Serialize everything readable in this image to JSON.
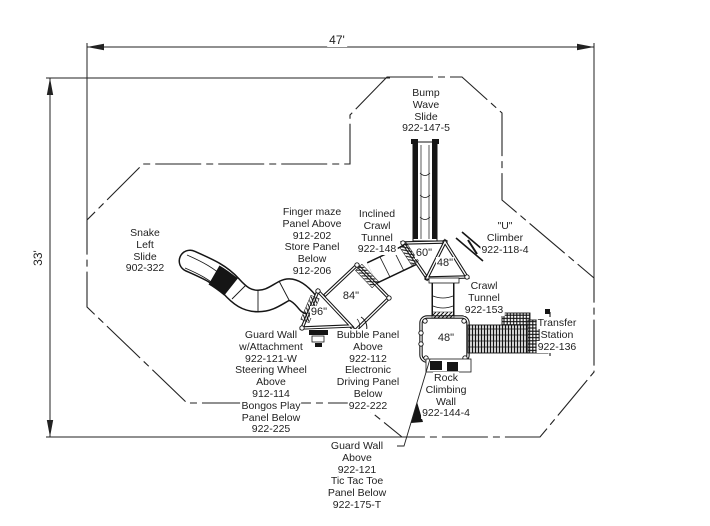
{
  "drawing_type": "playground plan view",
  "colors": {
    "line": "#222222",
    "equipment_line": "#151515",
    "text": "#1f1f1f",
    "background": "#ffffff"
  },
  "dimensions": {
    "width_label": "47'",
    "height_label": "33'"
  },
  "deck_labels": [
    {
      "id": "deck-84",
      "text": "84\"",
      "x": 351,
      "y": 296
    },
    {
      "id": "deck-96",
      "text": "96\"",
      "x": 319,
      "y": 312
    },
    {
      "id": "deck-60",
      "text": "60\"",
      "x": 424,
      "y": 253
    },
    {
      "id": "deck-48-triangle",
      "text": "48\"",
      "x": 445,
      "y": 263
    },
    {
      "id": "deck-48-square",
      "text": "48\"",
      "x": 446,
      "y": 338
    }
  ],
  "equipment_labels": [
    {
      "id": "snake-left-slide",
      "x": 145,
      "y": 228,
      "lines": [
        "Snake",
        "Left",
        "Slide",
        "902-322"
      ]
    },
    {
      "id": "finger-maze-panel",
      "x": 312,
      "y": 207,
      "lines": [
        "Finger maze",
        "Panel Above",
        "912-202",
        "Store Panel",
        "Below",
        "912-206"
      ]
    },
    {
      "id": "inclined-crawl-tunnel",
      "x": 377,
      "y": 209,
      "lines": [
        "Inclined",
        "Crawl",
        "Tunnel",
        "922-148"
      ]
    },
    {
      "id": "bump-wave-slide",
      "x": 426,
      "y": 88,
      "lines": [
        "Bump",
        "Wave",
        "Slide",
        "922-147-5"
      ]
    },
    {
      "id": "u-climber",
      "x": 505,
      "y": 221,
      "lines": [
        "\"U\"",
        "Climber",
        "922-118-4"
      ]
    },
    {
      "id": "crawl-tunnel",
      "x": 484,
      "y": 281,
      "lines": [
        "Crawl",
        "Tunnel",
        "922-153"
      ]
    },
    {
      "id": "transfer-station",
      "x": 557,
      "y": 318,
      "lines": [
        "Transfer",
        "Station",
        "922-136"
      ]
    },
    {
      "id": "guard-wall-attachment",
      "x": 271,
      "y": 330,
      "lines": [
        "Guard Wall",
        "w/Attachment",
        "922-121-W",
        "Steering Wheel",
        "Above",
        "912-114",
        "Bongos Play",
        "Panel Below",
        "922-225"
      ]
    },
    {
      "id": "bubble-panel",
      "x": 368,
      "y": 330,
      "lines": [
        "Bubble Panel",
        "Above",
        "922-112",
        "Electronic",
        "Driving Panel",
        "Below",
        "922-222"
      ]
    },
    {
      "id": "rock-climbing-wall",
      "x": 446,
      "y": 373,
      "lines": [
        "Rock",
        "Climbing",
        "Wall",
        "922-144-4"
      ]
    },
    {
      "id": "guard-wall-above",
      "x": 357,
      "y": 441,
      "lines": [
        "Guard Wall",
        "Above",
        "922-121",
        "Tic Tac Toe",
        "Panel Below",
        "922-175-T"
      ]
    }
  ]
}
